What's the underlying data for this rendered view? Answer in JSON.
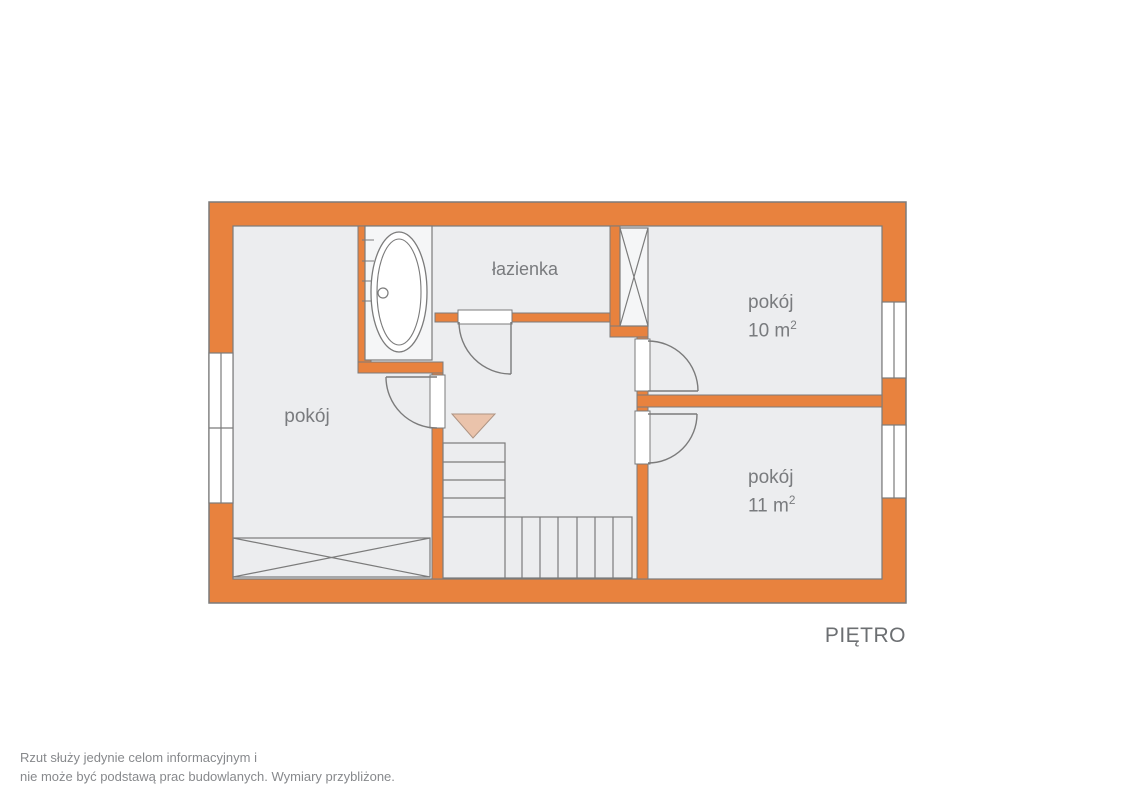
{
  "plan": {
    "floor_label": "PIĘTRO",
    "rooms": {
      "bathroom": {
        "label": "łazienka"
      },
      "room_left": {
        "label": "pokój"
      },
      "room_10": {
        "label": "pokój",
        "area_base": "10 m",
        "area_sup": "2"
      },
      "room_11": {
        "label": "pokój",
        "area_base": "11 m",
        "area_sup": "2"
      }
    }
  },
  "disclaimer": {
    "line1": "Rzut służy jedynie celom informacyjnym i",
    "line2": "nie może być podstawą prac budowlanych. Wymiary przybliżone."
  },
  "colors": {
    "wall_fill": "#E8823E",
    "room_fill": "#ECEDEF",
    "outline": "#7B7B7B",
    "stairs_arrow_fill": "#EAC3AB",
    "label_text": "#797B7E",
    "floor_text": "#6C6F72",
    "note_text": "#87898C"
  }
}
